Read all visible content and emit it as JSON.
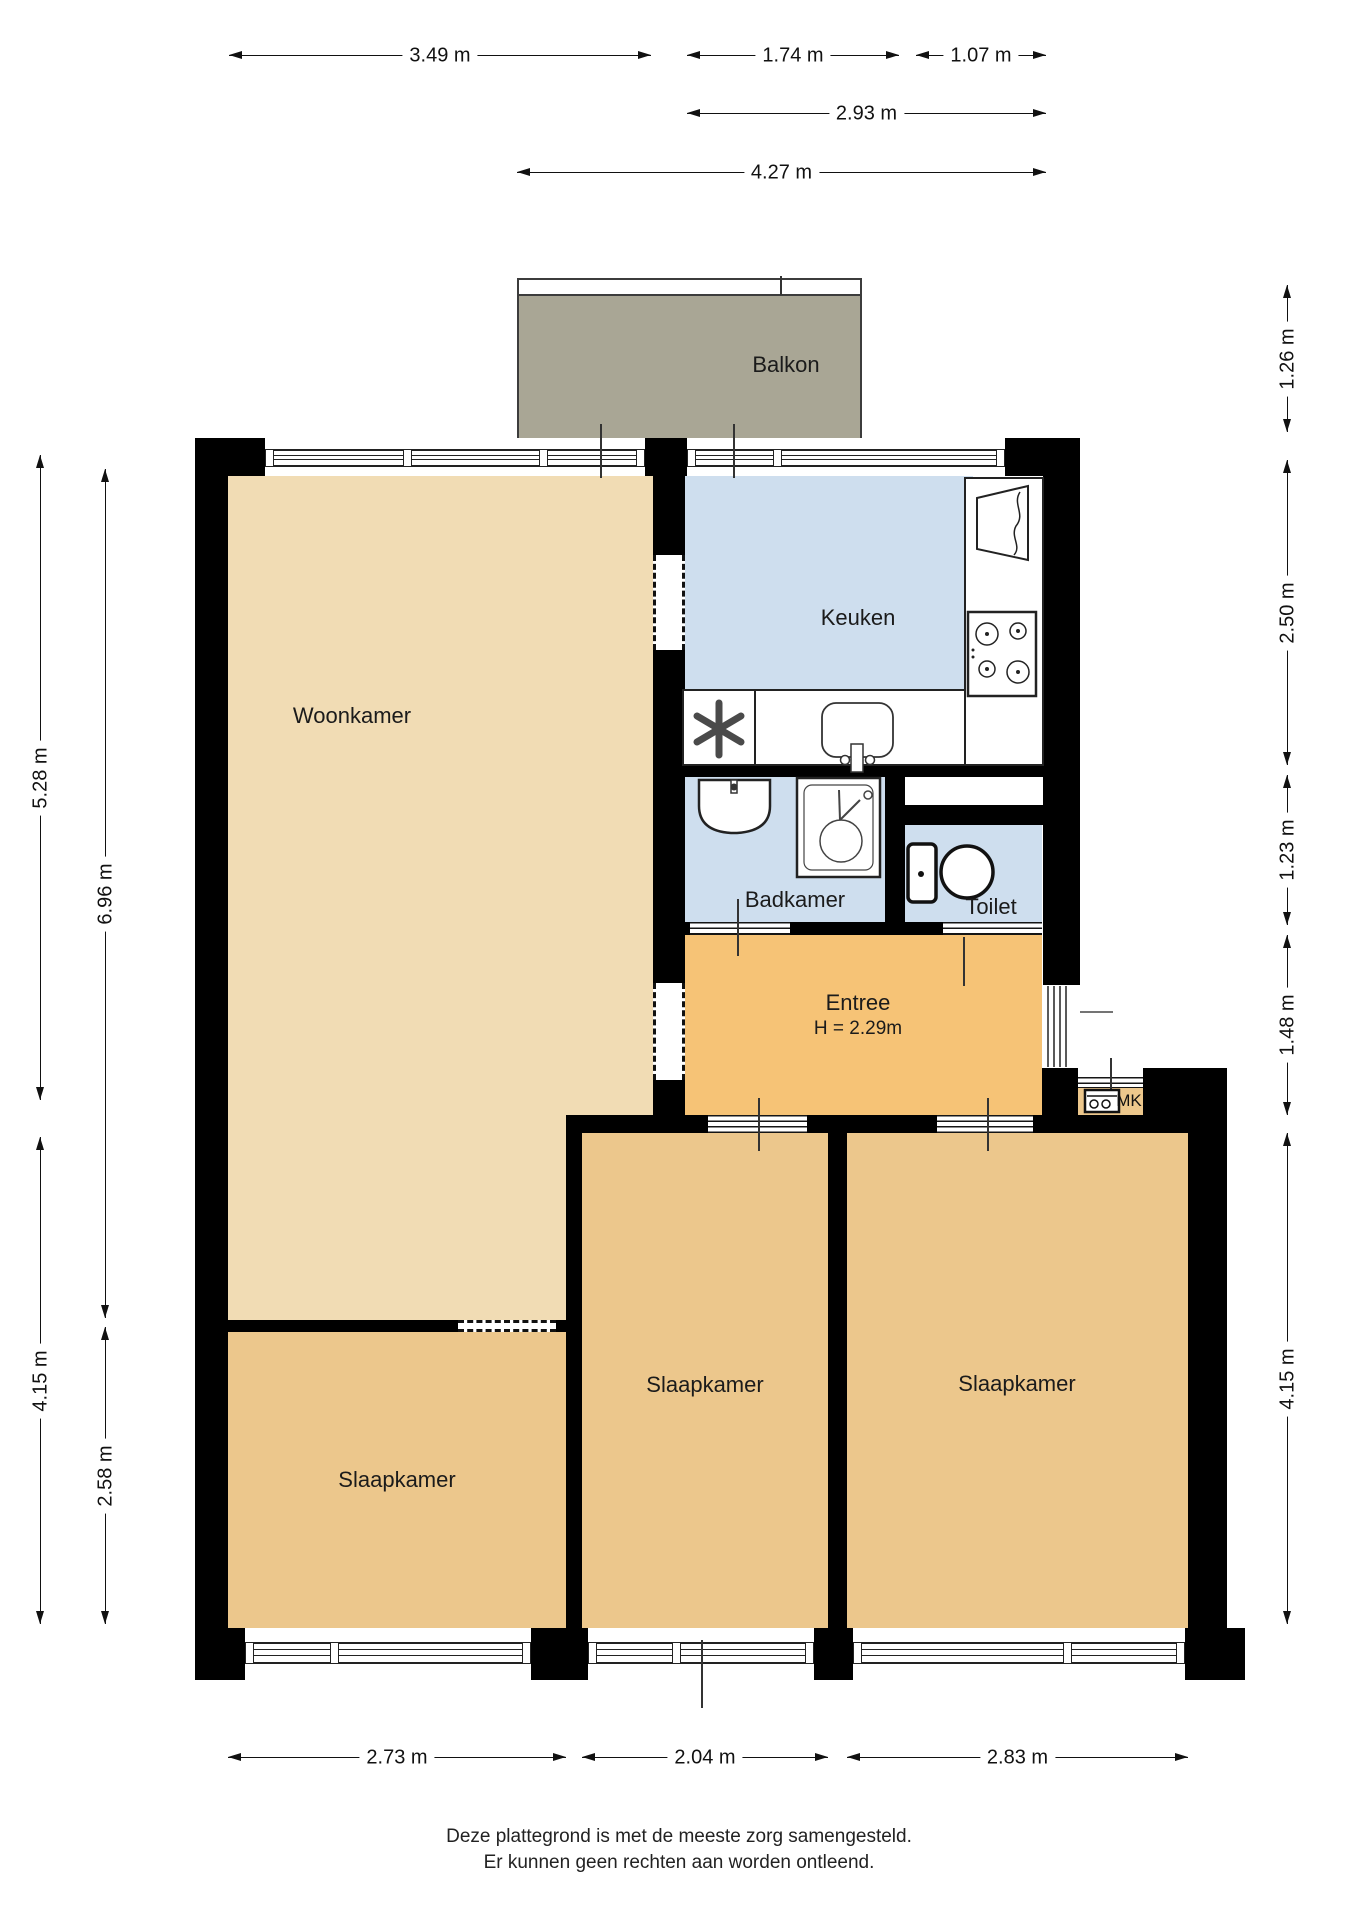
{
  "colors": {
    "wall": "#000000",
    "woonkamer": "#f1dcb4",
    "slaapkamer": "#ecc78c",
    "entree": "#f6c376",
    "natte_ruimte": "#cedeee",
    "balkon": "#a9a695",
    "background": "#ffffff",
    "line": "#111111"
  },
  "rooms": {
    "balkon": {
      "label": "Balkon"
    },
    "woonkamer": {
      "label": "Woonkamer"
    },
    "keuken": {
      "label": "Keuken"
    },
    "badkamer": {
      "label": "Badkamer"
    },
    "toilet": {
      "label": "Toilet"
    },
    "entree": {
      "label": "Entree",
      "ceiling_height": "H = 2.29m"
    },
    "slaapkamer_linksonder": {
      "label": "Slaapkamer"
    },
    "slaapkamer_midden": {
      "label": "Slaapkamer"
    },
    "slaapkamer_rechts": {
      "label": "Slaapkamer"
    },
    "meterkast": {
      "label": "MK"
    }
  },
  "dimensions": {
    "top": [
      {
        "label": "3.49 m"
      },
      {
        "label": "1.74 m"
      },
      {
        "label": "1.07 m"
      },
      {
        "label": "2.93 m"
      },
      {
        "label": "4.27 m"
      }
    ],
    "left": [
      {
        "label": "5.28 m"
      },
      {
        "label": "6.96 m"
      },
      {
        "label": "4.15 m"
      },
      {
        "label": "2.58 m"
      }
    ],
    "right": [
      {
        "label": "1.26 m"
      },
      {
        "label": "2.50 m"
      },
      {
        "label": "1.23 m"
      },
      {
        "label": "1.48 m"
      },
      {
        "label": "4.15 m"
      }
    ],
    "bottom": [
      {
        "label": "2.73 m"
      },
      {
        "label": "2.04 m"
      },
      {
        "label": "2.83 m"
      }
    ]
  },
  "footer": {
    "line1": "Deze plattegrond is met de meeste zorg samengesteld.",
    "line2": "Er kunnen geen rechten aan worden ontleend."
  }
}
